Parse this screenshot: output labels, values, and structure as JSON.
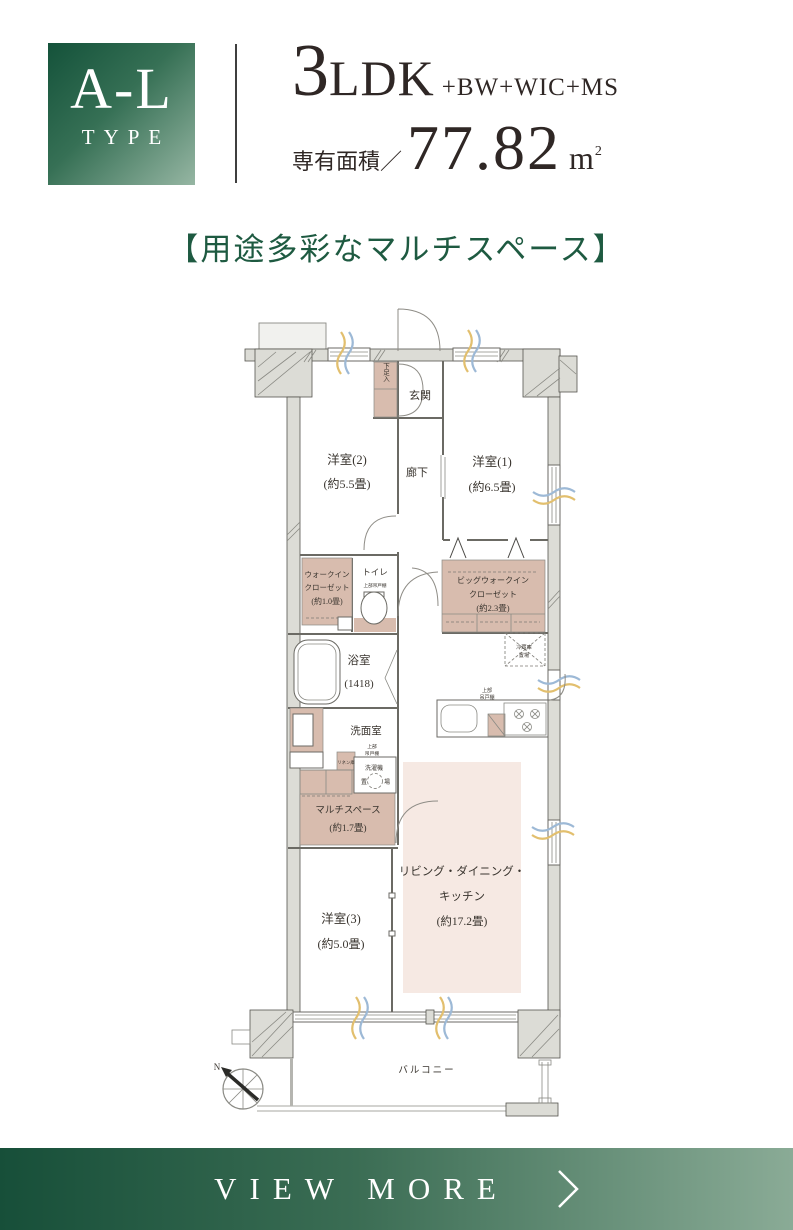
{
  "header": {
    "type": "A-L",
    "type_sub": "TYPE",
    "plan_number": "3",
    "plan_letters": "LDK",
    "plan_suffix": "+BW+WIC+MS",
    "area_label": "専有面積／",
    "area_value": "77.82",
    "area_unit": "m",
    "area_sup": "2"
  },
  "headline": {
    "text": "【用途多彩なマルチスペース】"
  },
  "fp": {
    "genkan": "玄関",
    "shoe": "下足入",
    "west2": "洋室(2)",
    "west2_size": "(約5.5畳)",
    "hall": "廊下",
    "west1": "洋室(1)",
    "west1_size": "(約6.5畳)",
    "wic_l1": "ウォークイン",
    "wic_l2": "クローゼット",
    "wic_size": "(約1.0畳)",
    "toilet": "トイレ",
    "toilet_cab": "上部吊戸棚",
    "bwic_l1": "ビッグウォークイン",
    "bwic_l2": "クローゼット",
    "bwic_size": "(約2.3畳)",
    "bath": "浴室",
    "bath_size": "(1418)",
    "fridge_l1": "冷蔵庫",
    "fridge_l2": "置場",
    "kcab_l1": "上部",
    "kcab_l2": "吊戸棚",
    "wash": "洗面室",
    "lcab_l1": "上部",
    "lcab_l2": "吊戸棚",
    "laundry_l1": "洗濯機",
    "laundry_l2": "置",
    "laundry_l3": "場",
    "linen": "リネン庫",
    "multi": "マルチスペース",
    "multi_size": "(約1.7畳)",
    "ldk_l1": "リビング・ダイニング・",
    "ldk_l2": "キッチン",
    "ldk_size": "(約17.2畳)",
    "west3": "洋室(3)",
    "west3_size": "(約5.0畳)",
    "balcony": "バルコニー",
    "north": "N"
  },
  "footer": {
    "label": "VIEW MORE"
  },
  "colors": {
    "brand_green_dark": "#14523a",
    "brand_green_light": "#96b6a3",
    "headline_green": "#1e5a41",
    "text_dark": "#2f2725",
    "closet_beige": "#d8bcae",
    "ldk_pink": "#f6e9e3",
    "wall_gray": "#dcdcd6",
    "window_blue": "#9db9d6",
    "window_yellow": "#e2bf6e"
  }
}
